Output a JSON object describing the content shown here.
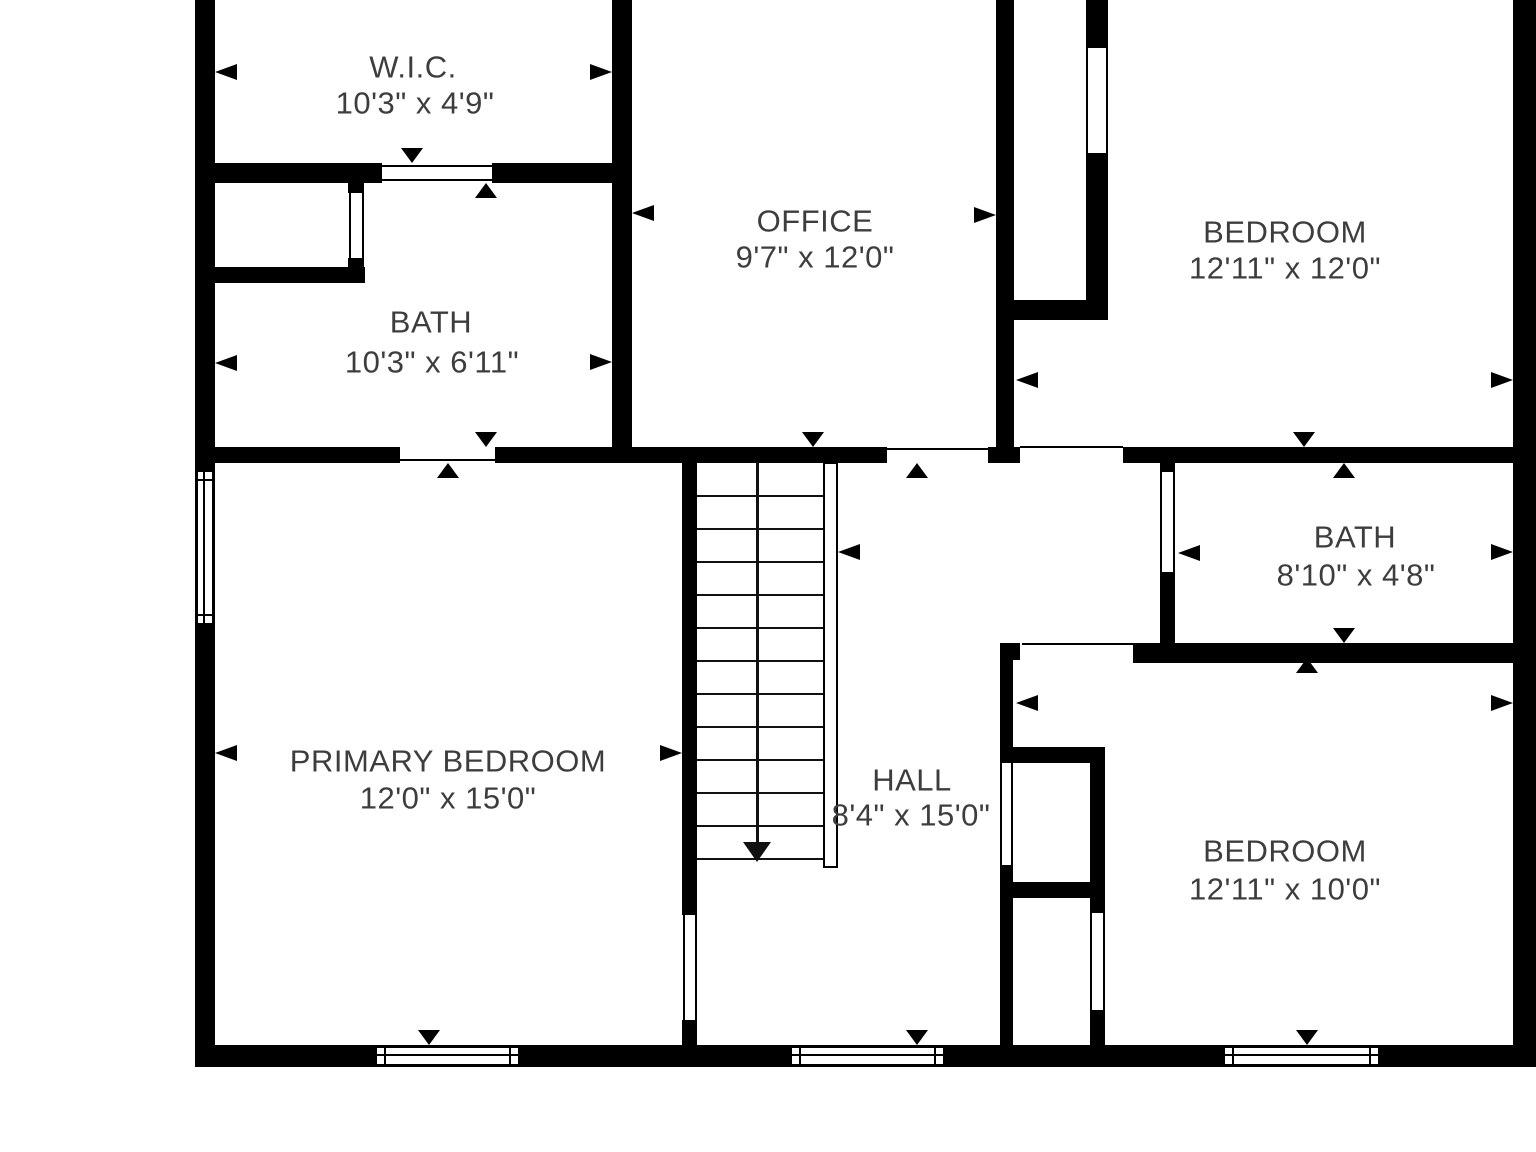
{
  "title": "Floor plan - upper level",
  "colors": {
    "wall": "#000000",
    "text": "#3d3d3d",
    "background": "#ffffff"
  },
  "rooms": [
    {
      "id": "wic",
      "name": "W.I.C.",
      "dims": "10'3\" x 4'9\"",
      "cx": 413,
      "cy": 67,
      "dx": 415,
      "dy": 103
    },
    {
      "id": "bath1",
      "name": "BATH",
      "dims": "10'3\" x 6'11\"",
      "cx": 431,
      "cy": 322,
      "dx": 432,
      "dy": 362
    },
    {
      "id": "office",
      "name": "OFFICE",
      "dims": "9'7\" x 12'0\"",
      "cx": 815,
      "cy": 221,
      "dx": 815,
      "dy": 257
    },
    {
      "id": "bedroom1",
      "name": "BEDROOM",
      "dims": "12'11\" x 12'0\"",
      "cx": 1285,
      "cy": 232,
      "dx": 1285,
      "dy": 268
    },
    {
      "id": "bath2",
      "name": "BATH",
      "dims": "8'10\" x 4'8\"",
      "cx": 1355,
      "cy": 537,
      "dx": 1356,
      "dy": 575
    },
    {
      "id": "primary",
      "name": "PRIMARY BEDROOM",
      "dims": "12'0\" x 15'0\"",
      "cx": 448,
      "cy": 761,
      "dx": 448,
      "dy": 798
    },
    {
      "id": "hall",
      "name": "HALL",
      "dims": "8'4\" x 15'0\"",
      "cx": 912,
      "cy": 780,
      "dx": 911,
      "dy": 815
    },
    {
      "id": "bedroom2",
      "name": "BEDROOM",
      "dims": "12'11\" x 10'0\"",
      "cx": 1285,
      "cy": 851,
      "dx": 1285,
      "dy": 889
    }
  ],
  "plan": {
    "walls": [
      [
        195,
        0,
        20,
        1067
      ],
      [
        1513,
        0,
        23,
        1067
      ],
      [
        195,
        1045,
        1341,
        22
      ],
      [
        612,
        0,
        20,
        463
      ],
      [
        996,
        0,
        18,
        448
      ],
      [
        988,
        447,
        32,
        16
      ],
      [
        1086,
        0,
        22,
        48
      ],
      [
        1086,
        153,
        22,
        167
      ],
      [
        1014,
        300,
        94,
        20
      ],
      [
        195,
        163,
        187,
        20
      ],
      [
        492,
        163,
        140,
        20
      ],
      [
        348,
        163,
        16,
        30
      ],
      [
        348,
        258,
        16,
        25
      ],
      [
        215,
        267,
        150,
        16
      ],
      [
        195,
        447,
        205,
        16
      ],
      [
        495,
        447,
        392,
        16
      ],
      [
        1123,
        447,
        390,
        16
      ],
      [
        682,
        462,
        15,
        453
      ],
      [
        682,
        1020,
        15,
        27
      ],
      [
        1000,
        643,
        13,
        120
      ],
      [
        1000,
        865,
        13,
        182
      ],
      [
        1160,
        458,
        15,
        14
      ],
      [
        1160,
        572,
        15,
        81
      ],
      [
        1000,
        643,
        20,
        17
      ],
      [
        1133,
        643,
        380,
        20
      ],
      [
        1000,
        747,
        105,
        16
      ],
      [
        1090,
        747,
        15,
        166
      ],
      [
        1090,
        1010,
        15,
        37
      ],
      [
        1000,
        882,
        90,
        16
      ]
    ],
    "opening_lines": [
      [
        382,
        165,
        110,
        2
      ],
      [
        382,
        179,
        110,
        2
      ],
      [
        400,
        459,
        95,
        2
      ],
      [
        887,
        448,
        103,
        2
      ],
      [
        1020,
        446,
        103,
        2
      ],
      [
        1022,
        643,
        111,
        2
      ],
      [
        1086,
        48,
        2,
        105
      ],
      [
        1106,
        48,
        2,
        105
      ],
      [
        1160,
        472,
        2,
        100
      ],
      [
        1173,
        472,
        2,
        100
      ],
      [
        683,
        915,
        2,
        105
      ],
      [
        695,
        915,
        2,
        105
      ],
      [
        1000,
        763,
        2,
        102
      ],
      [
        1011,
        763,
        2,
        102
      ],
      [
        1090,
        913,
        2,
        97
      ],
      [
        1103,
        913,
        2,
        97
      ],
      [
        349,
        190,
        2,
        68
      ],
      [
        362,
        190,
        2,
        68
      ]
    ],
    "windows": [
      {
        "x": 196,
        "y": 470,
        "w": 18,
        "h": 155,
        "dir": "v"
      },
      {
        "x": 375,
        "y": 1046,
        "w": 145,
        "h": 20,
        "dir": "h"
      },
      {
        "x": 790,
        "y": 1046,
        "w": 155,
        "h": 20,
        "dir": "h"
      },
      {
        "x": 1223,
        "y": 1046,
        "w": 157,
        "h": 20,
        "dir": "h"
      }
    ],
    "arrows": [
      {
        "dir": "left",
        "x": 215,
        "y": 72
      },
      {
        "dir": "left",
        "x": 215,
        "y": 363
      },
      {
        "dir": "left",
        "x": 215,
        "y": 753
      },
      {
        "dir": "left",
        "x": 632,
        "y": 213
      },
      {
        "dir": "left",
        "x": 1016,
        "y": 380
      },
      {
        "dir": "left",
        "x": 1016,
        "y": 703
      },
      {
        "dir": "left",
        "x": 838,
        "y": 552
      },
      {
        "dir": "left",
        "x": 1178,
        "y": 553
      },
      {
        "dir": "right",
        "x": 612,
        "y": 72
      },
      {
        "dir": "right",
        "x": 612,
        "y": 362
      },
      {
        "dir": "right",
        "x": 996,
        "y": 215
      },
      {
        "dir": "right",
        "x": 682,
        "y": 753
      },
      {
        "dir": "right",
        "x": 1513,
        "y": 380
      },
      {
        "dir": "right",
        "x": 1513,
        "y": 552
      },
      {
        "dir": "right",
        "x": 1513,
        "y": 703
      },
      {
        "dir": "up",
        "x": 486,
        "y": 183
      },
      {
        "dir": "up",
        "x": 448,
        "y": 463
      },
      {
        "dir": "up",
        "x": 917,
        "y": 463
      },
      {
        "dir": "up",
        "x": 1344,
        "y": 463
      },
      {
        "dir": "up",
        "x": 1307,
        "y": 658
      },
      {
        "dir": "down",
        "x": 412,
        "y": 163
      },
      {
        "dir": "down",
        "x": 486,
        "y": 447
      },
      {
        "dir": "down",
        "x": 813,
        "y": 447
      },
      {
        "dir": "down",
        "x": 1304,
        "y": 447
      },
      {
        "dir": "down",
        "x": 1344,
        "y": 643
      },
      {
        "dir": "down",
        "x": 429,
        "y": 1045
      },
      {
        "dir": "down",
        "x": 917,
        "y": 1045
      },
      {
        "dir": "down",
        "x": 1307,
        "y": 1045
      }
    ],
    "stairs": {
      "x": 697,
      "y": 462,
      "w": 126,
      "h": 400,
      "tread_spacing": 33,
      "treads": 12,
      "rail": {
        "x": 823,
        "y": 462,
        "w": 15,
        "h": 406
      },
      "arrow_x": 757,
      "arrow_tip_y": 862
    }
  }
}
